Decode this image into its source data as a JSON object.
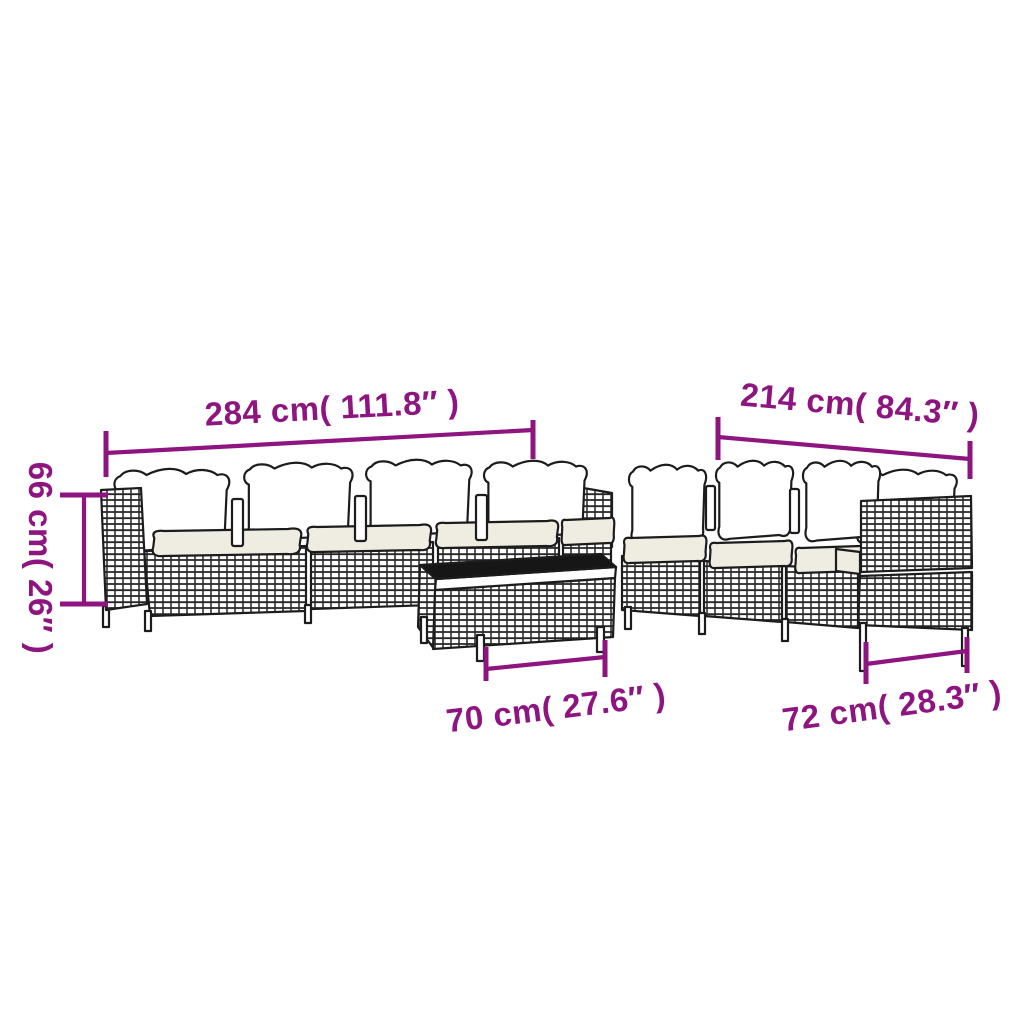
{
  "page": {
    "background_color": "#ffffff"
  },
  "diagram": {
    "kind": "furniture-dimension-diagram",
    "accent_color": "#8e1480",
    "line_art_color": "#1c1c1c",
    "back_cushion_color": "#ffffff",
    "seat_cushion_color": "#efece2",
    "table_top_color": "#161616",
    "dimensions": {
      "left_sofa_width": "284 cm( 111.8″ )",
      "right_sofa_width": "214 cm( 84.3″ )",
      "seat_height": "66 cm( 26″ )",
      "table_width": "70 cm( 27.6″ )",
      "module_width": "72 cm( 28.3″ )"
    }
  }
}
